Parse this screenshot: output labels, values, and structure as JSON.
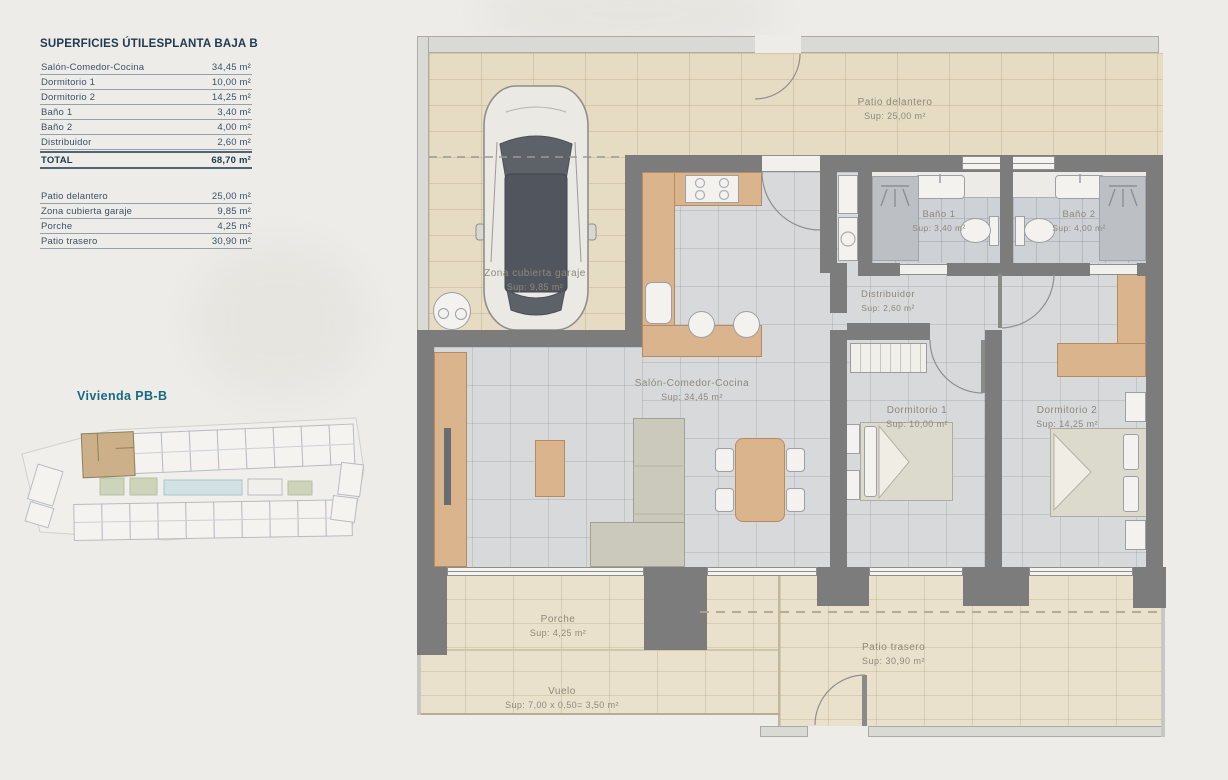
{
  "titles": {
    "left": "SUPERFICIES ÚTILES",
    "right": "PLANTA BAJA B"
  },
  "areas_table": {
    "rows": [
      {
        "label": "Salón-Comedor-Cocina",
        "value": "34,45 m²"
      },
      {
        "label": "Dormitorio 1",
        "value": "10,00 m²"
      },
      {
        "label": "Dormitorio 2",
        "value": "14,25 m²"
      },
      {
        "label": "Baño 1",
        "value": "3,40 m²"
      },
      {
        "label": "Baño 2",
        "value": "4,00 m²"
      },
      {
        "label": "Distribuidor",
        "value": "2,60 m²"
      }
    ],
    "total": {
      "label": "TOTAL",
      "value": "68,70 m²"
    },
    "outdoor_rows": [
      {
        "label": "Patio delantero",
        "value": "25,00 m²"
      },
      {
        "label": "Zona cubierta garaje",
        "value": "9,85 m²"
      },
      {
        "label": "Porche",
        "value": "4,25 m²"
      },
      {
        "label": "Patio trasero",
        "value": "30,90 m²"
      }
    ]
  },
  "site_plan": {
    "label": "Vivienda PB-B"
  },
  "floor_plan": {
    "patio_delantero": {
      "name": "Patio delantero",
      "sup": "Sup: 25,00 m²"
    },
    "zona_garaje": {
      "name": "Zona cubierta garaje",
      "sup": "Sup: 9,85 m²"
    },
    "bano1": {
      "name": "Baño 1",
      "sup": "Sup: 3,40 m²"
    },
    "bano2": {
      "name": "Baño 2",
      "sup": "Sup: 4,00 m²"
    },
    "distribuidor": {
      "name": "Distribuidor",
      "sup": "Sup: 2,60 m²"
    },
    "salon": {
      "name": "Salón-Comedor-Cocina",
      "sup": "Sup: 34,45 m²"
    },
    "dorm1": {
      "name": "Dormitorio 1",
      "sup": "Sup: 10,00 m²"
    },
    "dorm2": {
      "name": "Dormitorio 2",
      "sup": "Sup: 14,25 m²"
    },
    "porche": {
      "name": "Porche",
      "sup": "Sup: 4,25 m²"
    },
    "vuelo": {
      "name": "Vuelo",
      "sup": "Sup: 7,00 x 0,50= 3,50 m²"
    },
    "patio_trasero": {
      "name": "Patio trasero",
      "sup": "Sup: 30,90 m²"
    }
  },
  "colors": {
    "accent_teal": "#176a82",
    "table_text": "#3c5168",
    "plan_text": "#8e887c",
    "wall": "#7c7c7c"
  }
}
